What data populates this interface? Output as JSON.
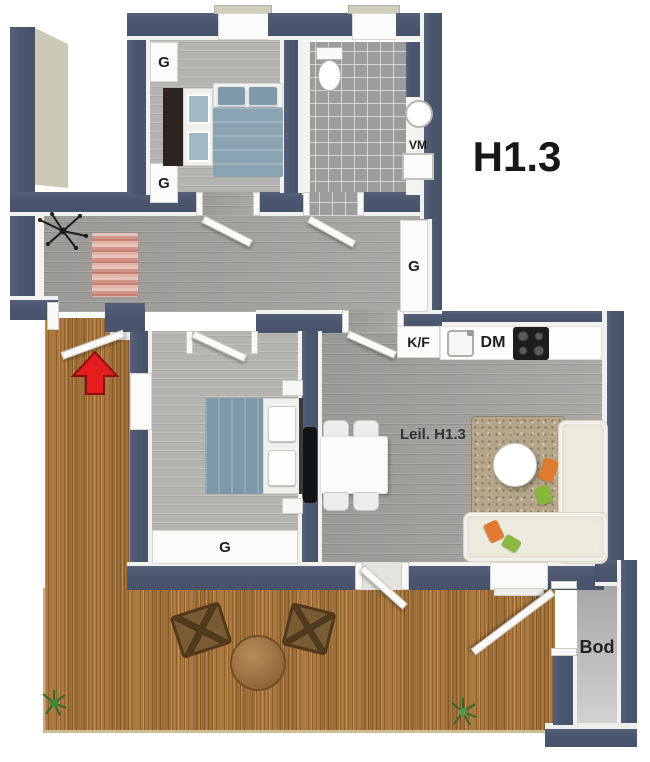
{
  "unit": {
    "plan_label": "H1.3"
  },
  "rooms": {
    "living": {
      "label": "Leil. H1.3"
    },
    "storage": {
      "label": "Bod"
    }
  },
  "fixtures": {
    "washing_machine": {
      "label": "VM"
    },
    "fridge_freezer": {
      "label": "K/F"
    },
    "dishwasher": {
      "label": "DM"
    }
  },
  "closets": [
    {
      "location": "bedroom-1-north",
      "label": "G"
    },
    {
      "location": "bedroom-1-south",
      "label": "G"
    },
    {
      "location": "hall-east",
      "label": "G"
    },
    {
      "location": "bedroom-2-south",
      "label": "G"
    }
  ],
  "icons": [
    "entrance-arrow-icon",
    "coat-rack-icon",
    "plant-icon"
  ],
  "colors": {
    "wall": "#4b576e",
    "deck_wood": "#ad783c",
    "entrance_arrow": "#e41e1e",
    "bed_linen": "#8ba4b3",
    "sofa": "#edeade",
    "hall_rug": "#d49387",
    "living_rug": "#b5a68a"
  }
}
